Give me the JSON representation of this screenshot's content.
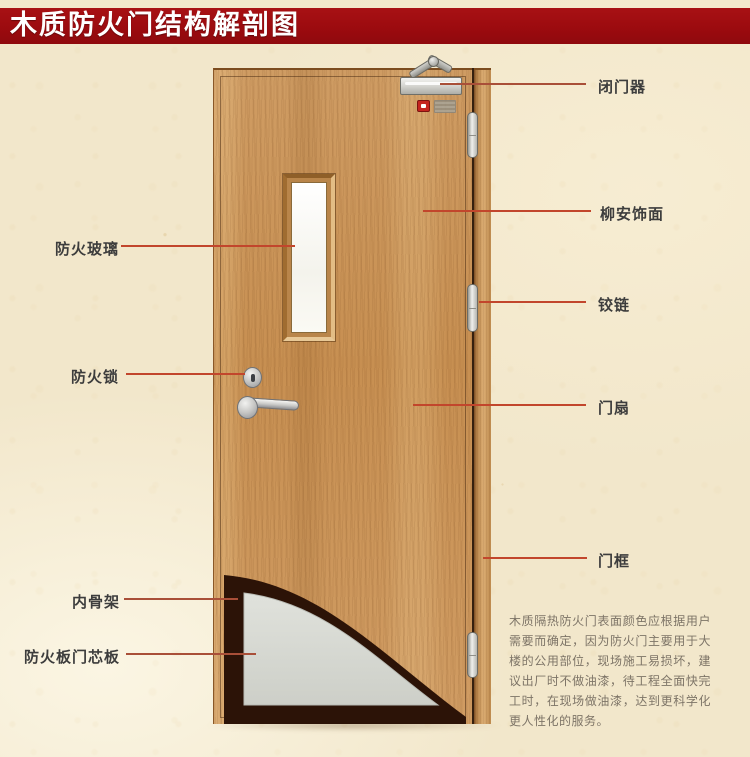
{
  "title": "木质防火门结构解剖图",
  "annotations": {
    "left": [
      {
        "label": "防火玻璃"
      },
      {
        "label": "防火锁"
      },
      {
        "label": "内骨架"
      },
      {
        "label": "防火板门芯板"
      }
    ],
    "right": [
      {
        "label": "闭门器"
      },
      {
        "label": "柳安饰面"
      },
      {
        "label": "铰链"
      },
      {
        "label": "门扇"
      },
      {
        "label": "门框"
      }
    ]
  },
  "description": "木质隔热防火门表面颜色应根据用户需要而确定，因为防火门主要用于大楼的公用部位，现场施工易损坏，建议出厂时不做油漆，待工程全面快完工时，在现场做油漆，达到更科学化更人性化的服务。",
  "colors": {
    "banner_red": "#9c0b0f",
    "leader_line_red": "#c2462c",
    "wood_tan": "#c9945a",
    "core_board_grey": "#d7d9d3",
    "skeleton_dark_brown": "#2c1307",
    "paper_cream": "#f2e7cb"
  }
}
